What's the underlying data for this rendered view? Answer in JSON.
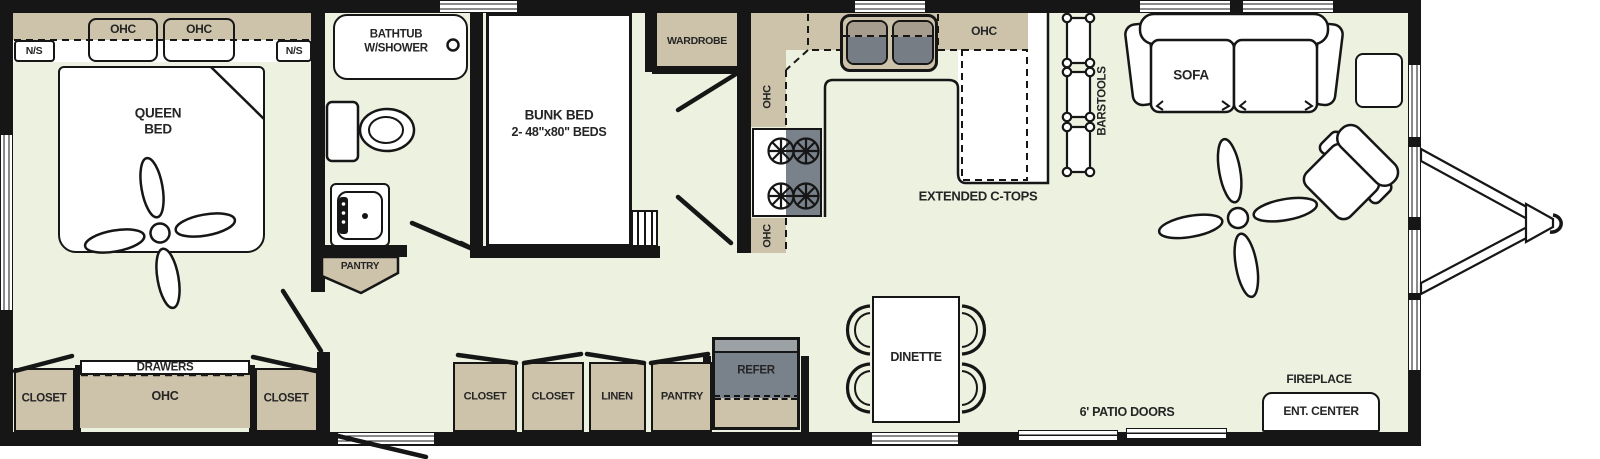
{
  "title": "RV travel trailer floor plan",
  "labels": {
    "bedroom_ohc_left": "OHC",
    "bedroom_ohc_right": "OHC",
    "ns_left": "N/S",
    "ns_right": "N/S",
    "queen_bed_l1": "QUEEN",
    "queen_bed_l2": "BED",
    "bedroom_closet_left": "CLOSET",
    "bedroom_closet_right": "CLOSET",
    "drawers": "DRAWERS",
    "drawers_ohc": "OHC",
    "bathtub_l1": "BATHTUB",
    "bathtub_l2": "W/SHOWER",
    "bath_pantry": "PANTRY",
    "bunk_l1": "BUNK BED",
    "bunk_l2": "2- 48\"x80\" BEDS",
    "wardrobe": "WARDROBE",
    "kitchen_ohc_upper": "OHC",
    "kitchen_ohc_lower": "OHC",
    "kitchen_ohc_right": "OHC",
    "extended_ctops": "EXTENDED C-TOPS",
    "barstools": "BARSTOOLS",
    "hall_closet_1": "CLOSET",
    "hall_closet_2": "CLOSET",
    "linen": "LINEN",
    "hall_pantry": "PANTRY",
    "refer": "REFER",
    "dinette": "DINETTE",
    "sofa": "SOFA",
    "patio_doors": "6' PATIO DOORS",
    "fireplace": "FIREPLACE",
    "ent_center": "ENT. CENTER"
  },
  "colors": {
    "floor": "#ecf1e0",
    "cabinet_tan": "#cdc3ab",
    "appliance_gray": "#79818a",
    "appliance_gray_light": "#9ba1a4",
    "wall_black": "#161616",
    "label_text": "#252525"
  }
}
